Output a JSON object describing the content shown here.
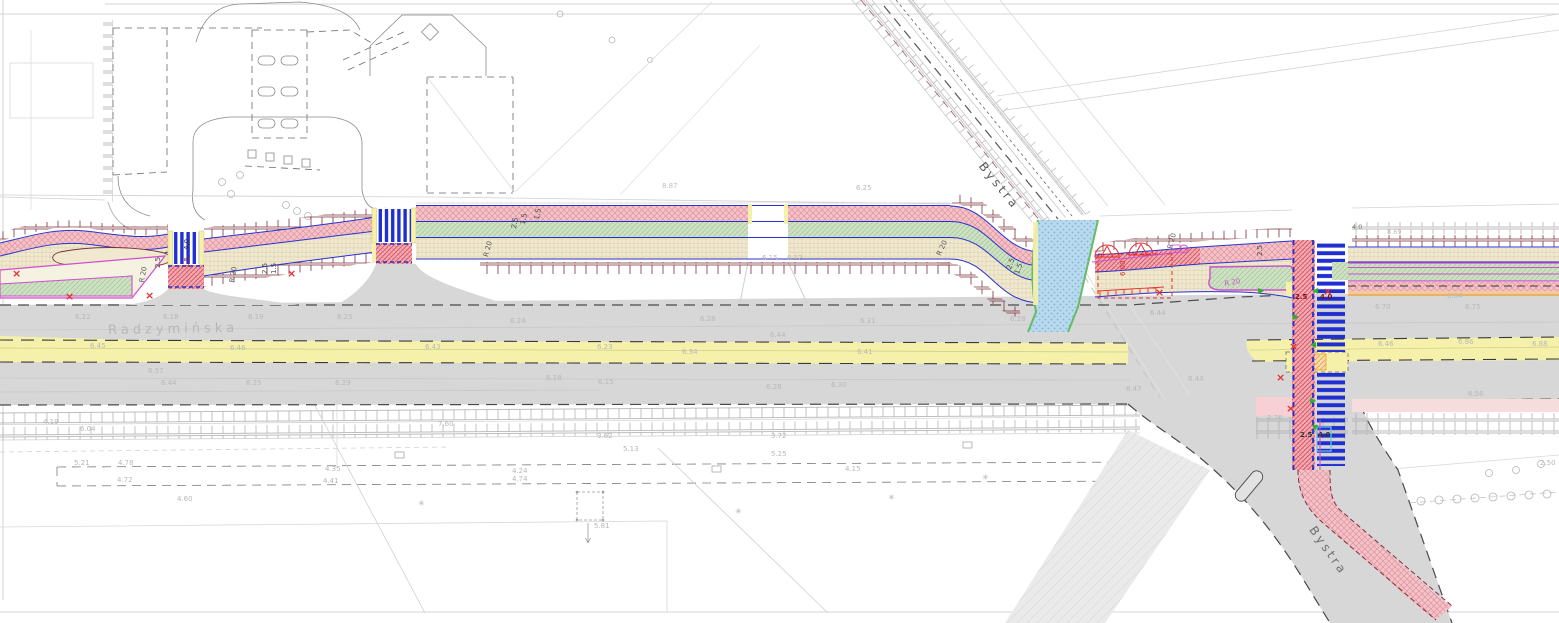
{
  "streets": {
    "main": "Radzymińska",
    "side_north": "Bystra",
    "side_south": "Bystra"
  },
  "colors": {
    "road_gray": "#d7d7d7",
    "pavement_light": "#eaeaea",
    "median_yellow": "#f5f1ab",
    "path_pink": "#f3c3c9",
    "pink_hatch": "#e2939d",
    "crossing_red": "#f2aeb6",
    "crossing_red_hatch": "#d64f5e",
    "strip_green": "#cfe2c4",
    "green_hatch": "#a3c79b",
    "island_green": "#c9dfc0",
    "path_beige": "#f0e8cf",
    "beige_hatch": "#d8cda9",
    "line_blue": "#2833cf",
    "zebra_blue": "#2030d0",
    "brick_maroon": "#7e2f39",
    "crossing_blue_fill": "#b8d9ee",
    "crossing_blue_dot": "#85b4d6",
    "magenta": "#cf4fcf",
    "red": "#e03030",
    "green_arrow": "#2fae2f",
    "orange": "#e8a030",
    "cyan": "#5fc8e6",
    "gray_line": "#c6c6c6",
    "dark_dash": "#4a4a4a"
  },
  "labels": [
    {
      "t": "2.5",
      "x": 155,
      "y": 268,
      "r": -90,
      "c": "#4a4a4a",
      "n": "dimension-label"
    },
    {
      "t": "1.5",
      "x": 184,
      "y": 268,
      "r": -90,
      "c": "#b02020",
      "n": "dimension-label"
    },
    {
      "t": "4.0",
      "x": 184,
      "y": 250,
      "r": -90,
      "c": "#333333",
      "n": "dimension-label"
    },
    {
      "t": "2.5",
      "x": 262,
      "y": 274,
      "r": -90,
      "c": "#4a4a4a",
      "n": "dimension-label"
    },
    {
      "t": "1.5",
      "x": 271,
      "y": 274,
      "r": -90,
      "c": "#4a4a4a",
      "n": "dimension-label"
    },
    {
      "t": "2.5",
      "x": 511,
      "y": 228,
      "r": -80,
      "c": "#4a4a4a",
      "n": "dimension-label"
    },
    {
      "t": "1.5",
      "x": 520,
      "y": 224,
      "r": -80,
      "c": "#4a4a4a",
      "n": "dimension-label"
    },
    {
      "t": "1.5",
      "x": 534,
      "y": 219,
      "r": -80,
      "c": "#4a4a4a",
      "n": "dimension-label"
    },
    {
      "t": "2.5",
      "x": 1006,
      "y": 268,
      "r": -70,
      "c": "#4a4a4a",
      "n": "dimension-label"
    },
    {
      "t": "1.5",
      "x": 1014,
      "y": 273,
      "r": -70,
      "c": "#4a4a4a",
      "n": "dimension-label"
    },
    {
      "t": "2.5",
      "x": 1257,
      "y": 256,
      "r": -90,
      "c": "#4a4a4a",
      "n": "dimension-label"
    },
    {
      "t": "6.00",
      "x": 1120,
      "y": 276,
      "r": -90,
      "c": "#d03030",
      "n": "dimension-label"
    },
    {
      "t": "2.5",
      "x": 1295,
      "y": 294,
      "r": 0,
      "c": "#7a1020",
      "w": 700,
      "n": "dimension-label"
    },
    {
      "t": "4.0",
      "x": 1320,
      "y": 294,
      "r": 0,
      "c": "#7a1020",
      "w": 700,
      "n": "dimension-label"
    },
    {
      "t": "2.5",
      "x": 1300,
      "y": 432,
      "r": 0,
      "c": "#333333",
      "w": 700,
      "n": "dimension-label"
    },
    {
      "t": "4.0",
      "x": 1318,
      "y": 432,
      "r": 0,
      "c": "#333333",
      "w": 700,
      "n": "dimension-label"
    },
    {
      "t": "R 20",
      "x": 139,
      "y": 282,
      "r": -80,
      "c": "#5a5a5a",
      "n": "radius-label"
    },
    {
      "t": "R 20",
      "x": 229,
      "y": 282,
      "r": -80,
      "c": "#5a5a5a",
      "n": "radius-label"
    },
    {
      "t": "R 20",
      "x": 483,
      "y": 256,
      "r": -75,
      "c": "#5a5a5a",
      "n": "radius-label"
    },
    {
      "t": "R 20",
      "x": 936,
      "y": 254,
      "r": -65,
      "c": "#5a5a5a",
      "n": "radius-label"
    },
    {
      "t": "R 20",
      "x": 1167,
      "y": 248,
      "r": -75,
      "c": "#5a5a5a",
      "n": "radius-label"
    },
    {
      "t": "R 20",
      "x": 1224,
      "y": 281,
      "r": -10,
      "c": "#cf4fcf",
      "n": "radius-label"
    },
    {
      "t": "8.87",
      "x": 662,
      "y": 183,
      "c": "#bdbdbd",
      "n": "spot-elevation"
    },
    {
      "t": "4.0",
      "x": 1352,
      "y": 224,
      "s": 6.5,
      "c": "#777777",
      "n": "dimension-label"
    },
    {
      "t": "8.69",
      "x": 1387,
      "y": 229,
      "s": 6.5,
      "c": "#bdbdbd",
      "n": "spot-elevation"
    },
    {
      "t": "6.22",
      "x": 75,
      "y": 314,
      "n": "spot-elevation"
    },
    {
      "t": "6.18",
      "x": 163,
      "y": 314,
      "n": "spot-elevation"
    },
    {
      "t": "6.19",
      "x": 248,
      "y": 314,
      "n": "spot-elevation"
    },
    {
      "t": "6.25",
      "x": 337,
      "y": 314,
      "n": "spot-elevation"
    },
    {
      "t": "6.24",
      "x": 510,
      "y": 318,
      "n": "spot-elevation"
    },
    {
      "t": "6.28",
      "x": 700,
      "y": 316,
      "n": "spot-elevation"
    },
    {
      "t": "6.31",
      "x": 860,
      "y": 318,
      "n": "spot-elevation"
    },
    {
      "t": "6.28",
      "x": 1010,
      "y": 316,
      "n": "spot-elevation"
    },
    {
      "t": "6.44",
      "x": 1150,
      "y": 310,
      "n": "spot-elevation"
    },
    {
      "t": "6.70",
      "x": 1375,
      "y": 304,
      "n": "spot-elevation"
    },
    {
      "t": "6.75",
      "x": 1465,
      "y": 304,
      "n": "spot-elevation"
    },
    {
      "t": "6.64",
      "x": 1447,
      "y": 293,
      "n": "spot-elevation"
    },
    {
      "t": "6.45",
      "x": 90,
      "y": 343,
      "n": "spot-elevation"
    },
    {
      "t": "6.46",
      "x": 230,
      "y": 345,
      "n": "spot-elevation"
    },
    {
      "t": "6.43",
      "x": 425,
      "y": 344,
      "n": "spot-elevation"
    },
    {
      "t": "6.23",
      "x": 597,
      "y": 344,
      "n": "spot-elevation"
    },
    {
      "t": "6.34",
      "x": 682,
      "y": 349,
      "n": "spot-elevation"
    },
    {
      "t": "6.44",
      "x": 770,
      "y": 332,
      "n": "spot-elevation"
    },
    {
      "t": "6.41",
      "x": 857,
      "y": 349,
      "n": "spot-elevation"
    },
    {
      "t": "6.46",
      "x": 1378,
      "y": 341,
      "n": "spot-elevation"
    },
    {
      "t": "6.86",
      "x": 1458,
      "y": 339,
      "n": "spot-elevation"
    },
    {
      "t": "6.88",
      "x": 1532,
      "y": 341,
      "n": "spot-elevation"
    },
    {
      "t": "6.57",
      "x": 148,
      "y": 368,
      "n": "spot-elevation"
    },
    {
      "t": "6.44",
      "x": 161,
      "y": 380,
      "n": "spot-elevation"
    },
    {
      "t": "6.25",
      "x": 246,
      "y": 380,
      "n": "spot-elevation"
    },
    {
      "t": "6.29",
      "x": 335,
      "y": 380,
      "n": "spot-elevation"
    },
    {
      "t": "6.18",
      "x": 546,
      "y": 375,
      "n": "spot-elevation"
    },
    {
      "t": "6.15",
      "x": 598,
      "y": 379,
      "n": "spot-elevation"
    },
    {
      "t": "6.28",
      "x": 766,
      "y": 384,
      "n": "spot-elevation"
    },
    {
      "t": "6.30",
      "x": 831,
      "y": 382,
      "n": "spot-elevation"
    },
    {
      "t": "6.44",
      "x": 1188,
      "y": 376,
      "n": "spot-elevation"
    },
    {
      "t": "6.47",
      "x": 1126,
      "y": 386,
      "n": "spot-elevation"
    },
    {
      "t": "6.56",
      "x": 1468,
      "y": 391,
      "n": "spot-elevation"
    },
    {
      "t": "6.25",
      "x": 856,
      "y": 185,
      "n": "spot-elevation"
    },
    {
      "t": "6.15",
      "x": 762,
      "y": 255,
      "n": "spot-elevation"
    },
    {
      "t": "6.12",
      "x": 787,
      "y": 255,
      "n": "spot-elevation"
    },
    {
      "t": "4.19",
      "x": 43,
      "y": 419,
      "n": "spot-elevation"
    },
    {
      "t": "6.04",
      "x": 80,
      "y": 426,
      "n": "spot-elevation"
    },
    {
      "t": "5.21",
      "x": 74,
      "y": 460,
      "n": "spot-elevation"
    },
    {
      "t": "4.78",
      "x": 118,
      "y": 460,
      "n": "spot-elevation"
    },
    {
      "t": "3.62",
      "x": 597,
      "y": 433,
      "n": "spot-elevation"
    },
    {
      "t": "3.72",
      "x": 771,
      "y": 433,
      "n": "spot-elevation"
    },
    {
      "t": "5.13",
      "x": 623,
      "y": 446,
      "n": "spot-elevation"
    },
    {
      "t": "5.25",
      "x": 771,
      "y": 451,
      "n": "spot-elevation"
    },
    {
      "t": "4.24",
      "x": 512,
      "y": 468,
      "n": "spot-elevation"
    },
    {
      "t": "4.74",
      "x": 512,
      "y": 476,
      "n": "spot-elevation"
    },
    {
      "t": "4.15",
      "x": 845,
      "y": 466,
      "n": "spot-elevation"
    },
    {
      "t": "4.41",
      "x": 323,
      "y": 478,
      "n": "spot-elevation"
    },
    {
      "t": "4.72",
      "x": 117,
      "y": 477,
      "n": "spot-elevation"
    },
    {
      "t": "4.60",
      "x": 177,
      "y": 496,
      "n": "spot-elevation"
    },
    {
      "t": "4.35",
      "x": 325,
      "y": 466,
      "n": "spot-elevation"
    },
    {
      "t": "7.60",
      "x": 438,
      "y": 421,
      "n": "spot-elevation"
    },
    {
      "t": "2.50",
      "x": 1540,
      "y": 460,
      "n": "spot-elevation"
    },
    {
      "t": "2.78",
      "x": 1267,
      "y": 415,
      "n": "spot-elevation"
    },
    {
      "t": "5.81",
      "x": 594,
      "y": 523,
      "n": "spot-elevation"
    },
    {
      "t": "✳",
      "x": 418,
      "y": 500,
      "s": 8,
      "c": "#b0b0b0",
      "n": "plant-symbol"
    },
    {
      "t": "✳",
      "x": 735,
      "y": 508,
      "s": 8,
      "c": "#b0b0b0",
      "n": "plant-symbol"
    },
    {
      "t": "✳",
      "x": 888,
      "y": 494,
      "s": 8,
      "c": "#b0b0b0",
      "n": "plant-symbol"
    },
    {
      "t": "✳",
      "x": 982,
      "y": 474,
      "s": 8,
      "c": "#b0b0b0",
      "n": "plant-symbol"
    }
  ],
  "markers": {
    "red_x": [
      {
        "x": 12,
        "y": 268
      },
      {
        "x": 65,
        "y": 291
      },
      {
        "x": 145,
        "y": 290
      },
      {
        "x": 287,
        "y": 268
      },
      {
        "x": 1155,
        "y": 287
      },
      {
        "x": 1323,
        "y": 286
      },
      {
        "x": 1289,
        "y": 341
      },
      {
        "x": 1276,
        "y": 372
      },
      {
        "x": 1286,
        "y": 403
      }
    ],
    "green_arrows": [
      {
        "x": 1312,
        "y": 287,
        "dir": "l"
      },
      {
        "x": 1293,
        "y": 313,
        "dir": "r"
      },
      {
        "x": 1310,
        "y": 341,
        "dir": "l"
      },
      {
        "x": 1258,
        "y": 287,
        "dir": "r"
      },
      {
        "x": 1310,
        "y": 397,
        "dir": "r"
      },
      {
        "x": 1312,
        "y": 424,
        "dir": "d"
      }
    ]
  }
}
